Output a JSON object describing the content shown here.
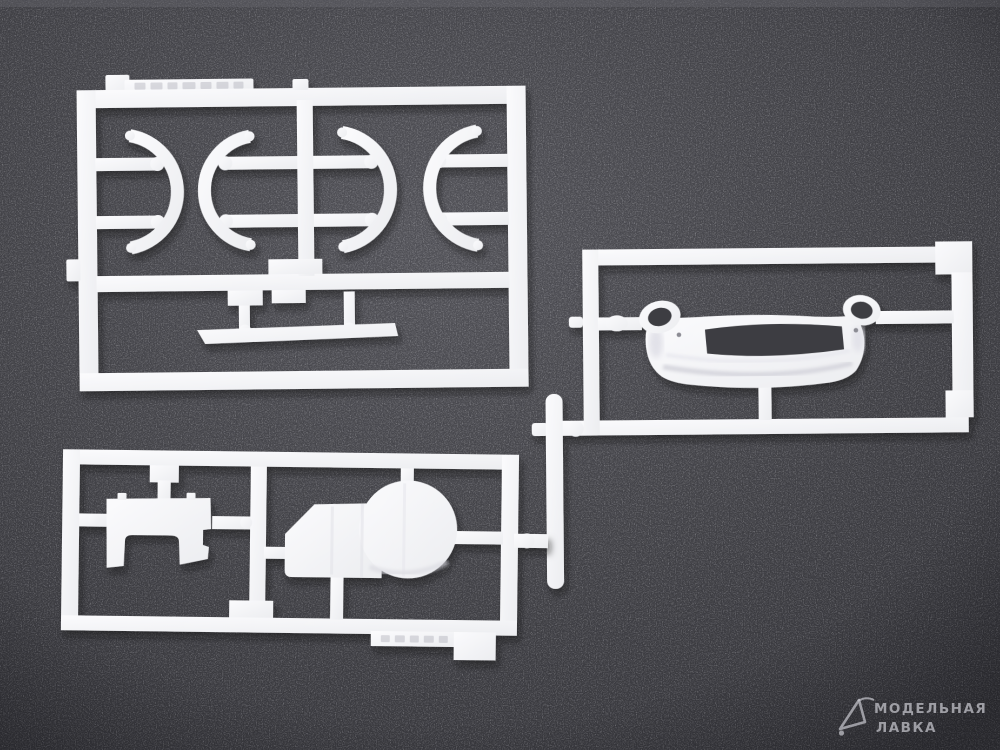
{
  "scene": {
    "type": "photograph",
    "description": "Unassembled white injection-molded plastic model kit sprues (runners with parts) lying on dark grey textured foam",
    "foam_color": "#46464b",
    "plastic_color": "#f4f4f6",
    "shadow_color": "#101014"
  },
  "sprues": {
    "top_left_frame": {
      "label": "sprue with four crescent wheel-arch parts",
      "parts": [
        "crescent arch part 1",
        "crescent arch part 2",
        "crescent arch part 3",
        "crescent arch part 4",
        "long flat sill strip",
        "molding tab with illegible embossed lettering"
      ]
    },
    "right_frame": {
      "label": "sprue with car body front panel",
      "parts": [
        "front body panel with two headlamp rings and rectangular grille opening"
      ]
    },
    "bottom_left_frame": {
      "label": "sprue with engine parts",
      "parts": [
        "notched bulkhead plate with arched cutout",
        "engine block with large round housing",
        "tab with illegible embossed marks"
      ]
    },
    "loose_runner": "cut vertical runner stub joining the two right-hand frames"
  },
  "watermark": {
    "line1": "МОДЕЛЬНАЯ",
    "line2": "ЛАВКА",
    "logo": "sail-boat outline logo",
    "color": "#c9c9d0"
  }
}
